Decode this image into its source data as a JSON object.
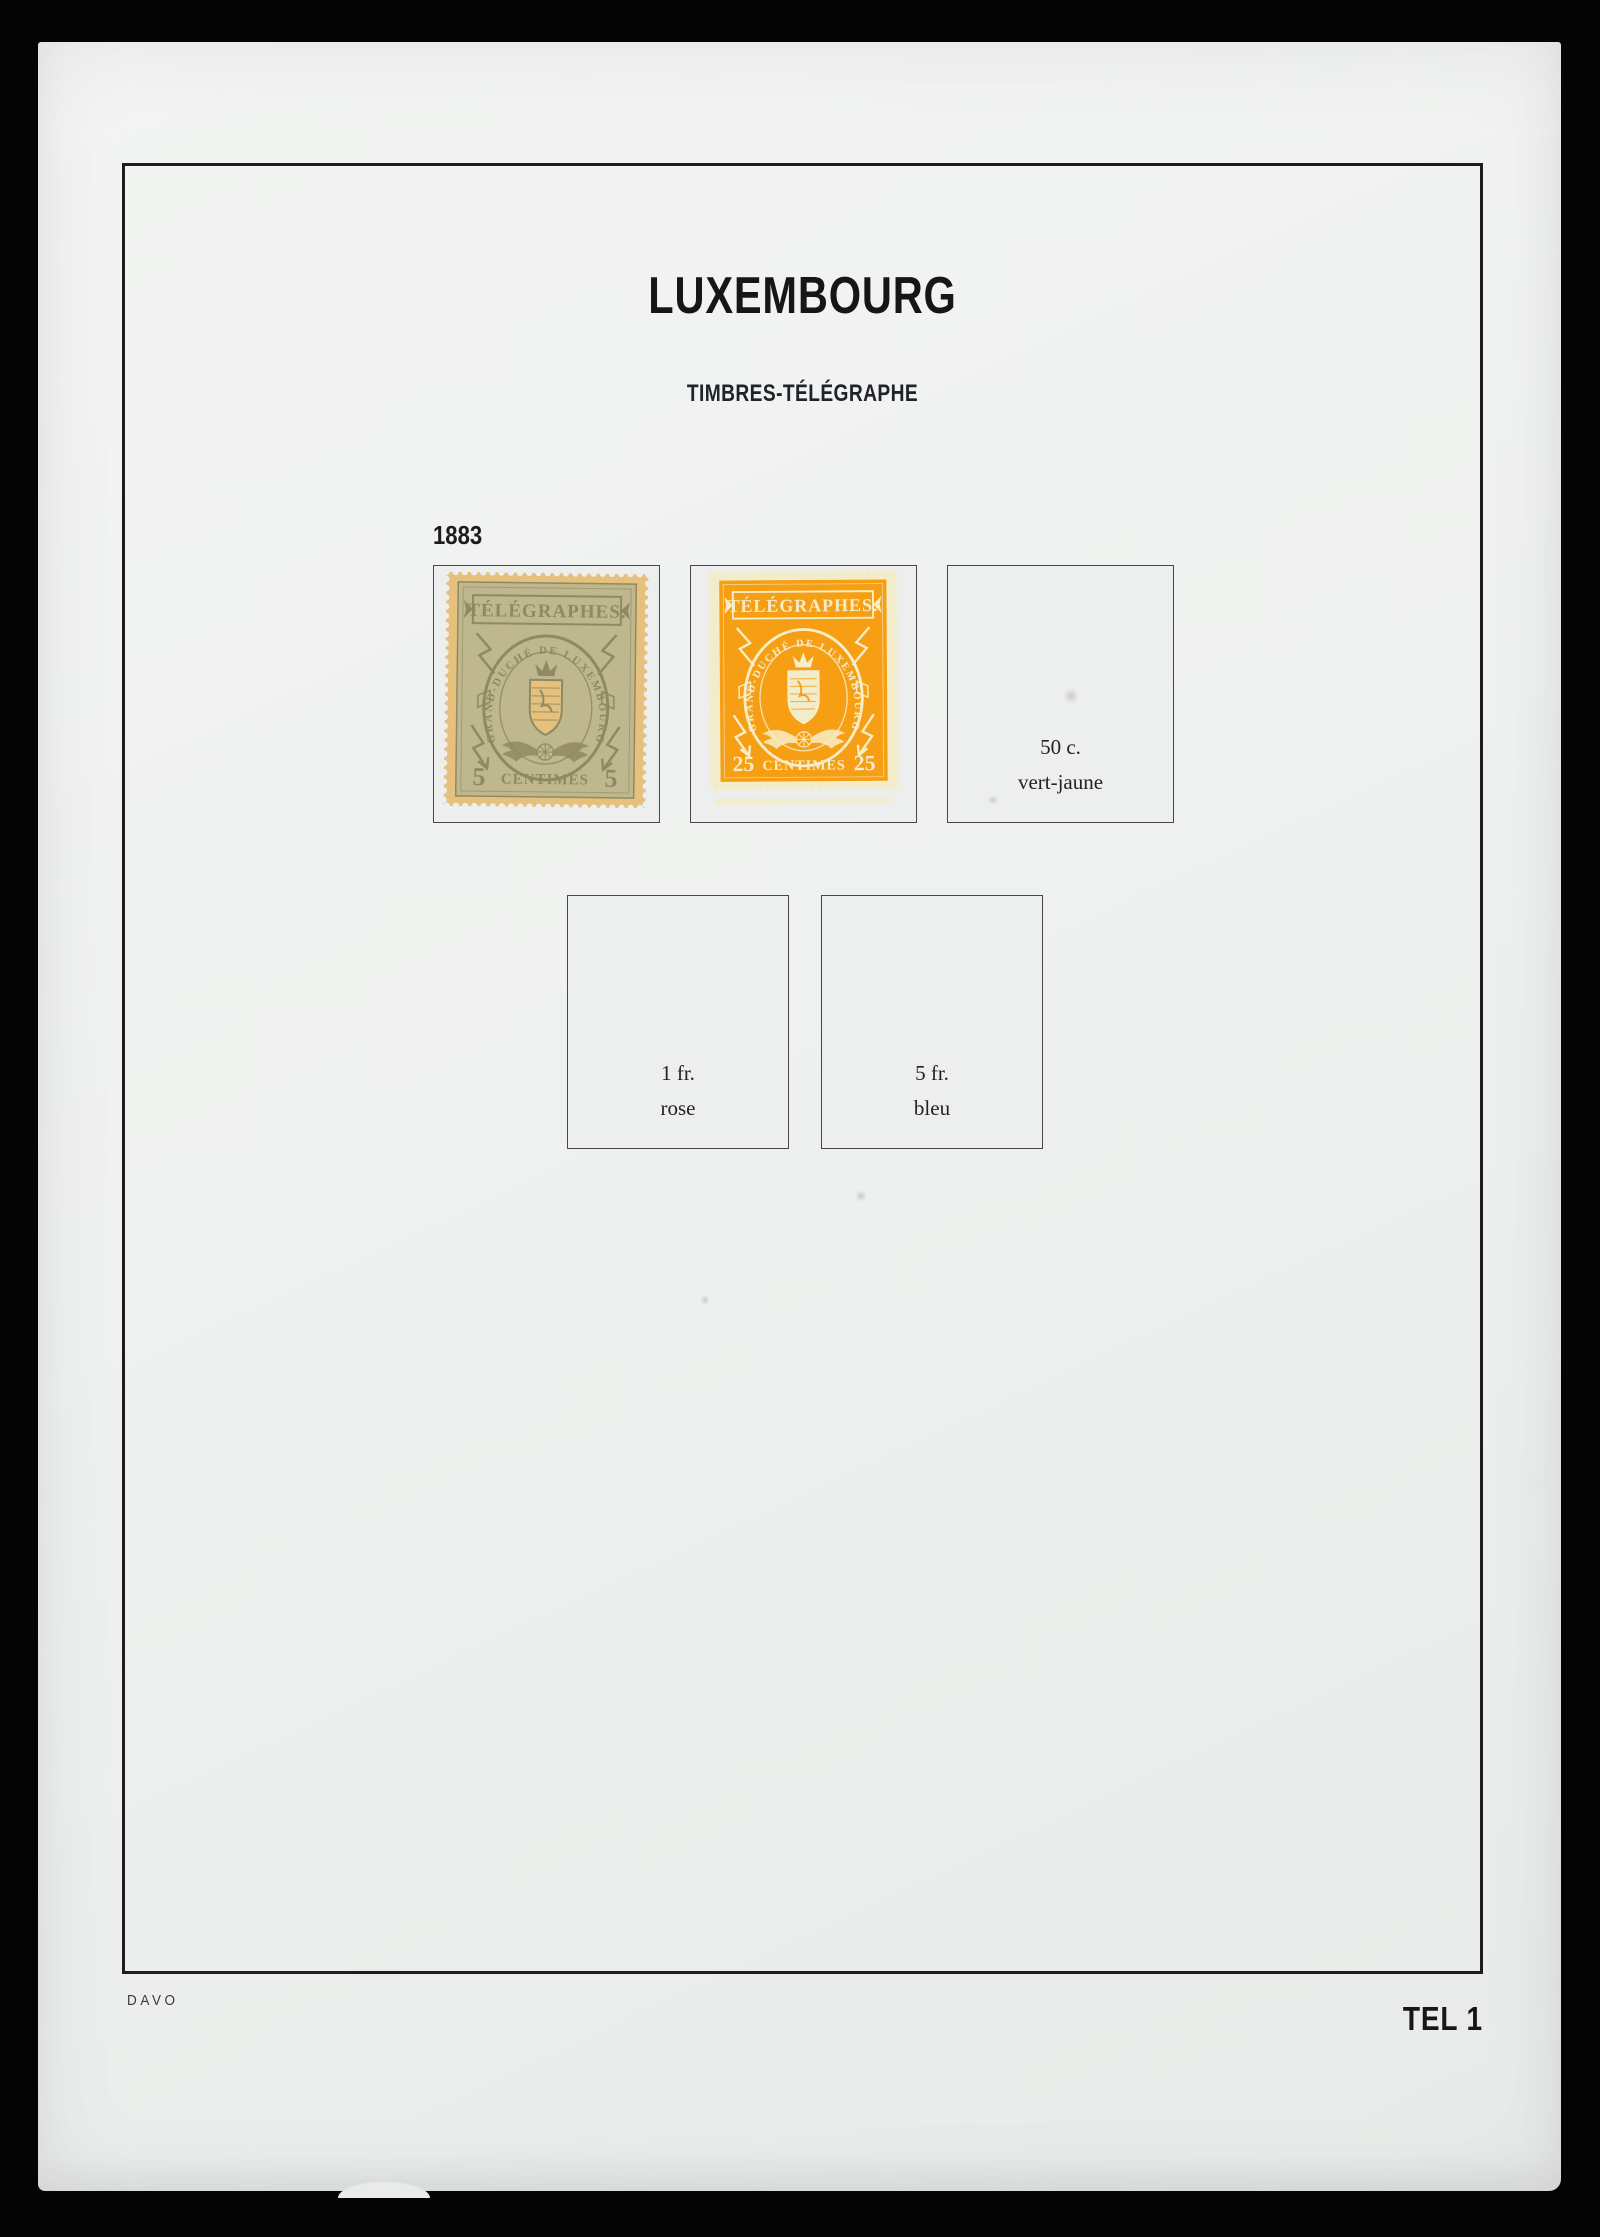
{
  "page": {
    "country_title": "LUXEMBOURG",
    "section_title": "TIMBRES-TÉLÉGRAPHE",
    "year": "1883",
    "publisher_mark": "DAVO",
    "page_code": "TEL 1"
  },
  "colors": {
    "photo_background": "#040404",
    "paper": "#eff1f0",
    "frame_line": "#1d1d1d",
    "box_fill": "#edeeee",
    "box_border": "#474747"
  },
  "stamps": [
    {
      "name": "telegraph-5-centimes-olive",
      "banner": "TÉLÉGRAPHES.",
      "oval_text": "GRAND-DUCHÉ DE LUXEMBOURG",
      "value_left": "5",
      "value_word": "CENTIMES",
      "value_right": "5",
      "paper_color": "#e6c17d",
      "field_color": "#bfb78d",
      "line_color": "#8f8a63"
    },
    {
      "name": "telegraph-25-centimes-orange",
      "banner": "TÉLÉGRAPHES.",
      "oval_text": "GRAND-DUCHÉ DE LUXEMBOURG",
      "value_left": "25",
      "value_word": "CENTIMES",
      "value_right": "25",
      "paper_color": "#f3ecca",
      "field_color": "#f69f15",
      "line_color": "#f7edc6"
    }
  ],
  "placeholders": [
    {
      "value": "50 c.",
      "color_name": "vert-jaune"
    },
    {
      "value": "1 fr.",
      "color_name": "rose"
    },
    {
      "value": "5 fr.",
      "color_name": "bleu"
    }
  ]
}
